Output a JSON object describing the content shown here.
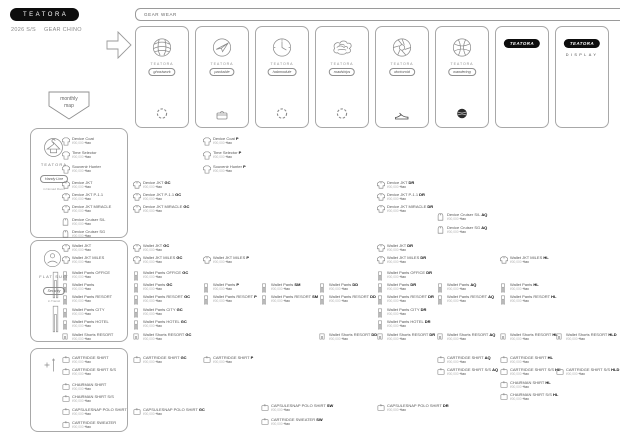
{
  "colors": {
    "accent": "#0d0d0d",
    "border": "#a8a8a8",
    "text": "#555555",
    "muted": "#b3b3b3"
  },
  "header": {
    "logo": "TEATORA",
    "season": "2026 S/S",
    "theme": "GEAR CHINO"
  },
  "banner": {
    "label": "GEAR WEAR"
  },
  "badge": {
    "line1": "monthly",
    "line2": "map"
  },
  "defaults": {
    "price": "¥00,000",
    "tax": "+tax"
  },
  "cards": [
    {
      "type": "icon",
      "brand": "TEATORA",
      "tag": "ghostwork",
      "icon": "globe-scribble-icon",
      "bottom_icon": "gear-ring-icon"
    },
    {
      "type": "icon",
      "brand": "TEATORA",
      "tag": "packable",
      "icon": "plane-scribble-icon",
      "bottom_icon": "basket-icon"
    },
    {
      "type": "icon",
      "brand": "TEATORA",
      "tag": "habmodule",
      "icon": "dial-scribble-icon",
      "bottom_icon": "gear-ring-icon"
    },
    {
      "type": "icon",
      "brand": "TEATORA",
      "tag": "roadships",
      "icon": "cloud-scribble-icon",
      "bottom_icon": "gear-ring-icon"
    },
    {
      "type": "icon",
      "brand": "TEATORA",
      "tag": "doctoroid",
      "icon": "aperture-scribble-icon",
      "bottom_icon": "sneaker-icon"
    },
    {
      "type": "icon",
      "brand": "TEATORA",
      "tag": "wandering",
      "icon": "yarn-scribble-icon",
      "bottom_icon": "knit-ball-icon"
    },
    {
      "type": "logo",
      "logo": "TEATORA"
    },
    {
      "type": "logo",
      "logo": "TEATORA",
      "sub": "DISPLAY"
    }
  ],
  "sections": [
    {
      "id": "outer",
      "box": {
        "y": 128,
        "h": 108
      },
      "header": {
        "brand": "TEATORA",
        "tag": "Handy Line",
        "caption": "in Nomad Room",
        "icon": "hanger-doodle-icon"
      },
      "items": [
        {
          "name": "Device Coat",
          "icon": "coat",
          "y": 137
        },
        {
          "name": "Time Selector",
          "icon": "coat",
          "y": 151
        },
        {
          "name": "Souvenir Hunter",
          "icon": "coat",
          "y": 165
        },
        {
          "name": "Device JKT",
          "icon": "jacket",
          "y": 181
        },
        {
          "name": "Device JKT P-1.1",
          "icon": "jacket",
          "y": 193
        },
        {
          "name": "Device JKT MIRACLE",
          "icon": "jacket",
          "y": 205
        },
        {
          "name": "Device Cruiser S/L",
          "icon": "vest",
          "y": 218
        },
        {
          "name": "Device Cruiser SG",
          "icon": "vest",
          "y": 230
        }
      ]
    },
    {
      "id": "pants",
      "box": {
        "y": 240,
        "h": 100
      },
      "header": {
        "brand": "FLAT SUIT",
        "tag": "Security",
        "caption": "in Transit",
        "icon": "person-doodle-icon"
      },
      "items": [
        {
          "name": "Wallet JKT",
          "icon": "jacket",
          "y": 244
        },
        {
          "name": "Wallet JKT MILES",
          "icon": "jacket",
          "y": 256
        },
        {
          "name": "Wallet Pants OFFICE",
          "icon": "pants",
          "y": 271
        },
        {
          "name": "Wallet Pants",
          "icon": "pants",
          "y": 283
        },
        {
          "name": "Wallet Pants RESORT",
          "icon": "pants",
          "y": 295
        },
        {
          "name": "Wallet Pants CITY",
          "icon": "pants",
          "y": 308
        },
        {
          "name": "Wallet Pants HOTEL",
          "icon": "pants",
          "y": 320
        },
        {
          "name": "Wallet Shorts RESORT",
          "icon": "shorts",
          "y": 333
        }
      ]
    },
    {
      "id": "shirts",
      "box": {
        "y": 348,
        "h": 82
      },
      "header": {
        "icon": "hanger-plus-icon"
      },
      "items": [
        {
          "name": "CARTRIDGE SHIRT",
          "icon": "shirt",
          "y": 356
        },
        {
          "name": "CARTRIDGE SHIRT S/S",
          "icon": "shirt",
          "y": 368
        },
        {
          "name": "CHAIRMAN SHIRT",
          "icon": "shirt",
          "y": 383
        },
        {
          "name": "CHAIRMAN SHIRT S/S",
          "icon": "shirt",
          "y": 395
        },
        {
          "name": "CAPSULESNAP POLO SHIRT",
          "icon": "shirt",
          "y": 408
        },
        {
          "name": "CARTRIDGE SWEATER",
          "icon": "shirt",
          "y": 421
        }
      ]
    }
  ],
  "grid": {
    "columns_x": [
      133,
      203,
      261,
      319,
      377,
      437,
      500,
      556
    ],
    "items": [
      {
        "c": 1,
        "y": 137,
        "name": "Device Coat",
        "code": "P",
        "icon": "coat"
      },
      {
        "c": 1,
        "y": 151,
        "name": "Time Selector",
        "code": "P",
        "icon": "coat"
      },
      {
        "c": 1,
        "y": 165,
        "name": "Souvenir Hunter",
        "code": "P",
        "icon": "coat"
      },
      {
        "c": 0,
        "y": 181,
        "name": "Device JKT",
        "code": "GC",
        "icon": "jacket"
      },
      {
        "c": 0,
        "y": 193,
        "name": "Device JKT P-1.1",
        "code": "GC",
        "icon": "jacket"
      },
      {
        "c": 0,
        "y": 205,
        "name": "Device JKT MIRACLE",
        "code": "GC",
        "icon": "jacket"
      },
      {
        "c": 4,
        "y": 181,
        "name": "Device JKT",
        "code": "DR",
        "icon": "jacket"
      },
      {
        "c": 4,
        "y": 193,
        "name": "Device JKT P-1.1",
        "code": "DR",
        "icon": "jacket"
      },
      {
        "c": 4,
        "y": 205,
        "name": "Device JKT MIRACLE",
        "code": "DR",
        "icon": "jacket"
      },
      {
        "c": 5,
        "y": 213,
        "name": "Device Cruiser S/L",
        "code": "AQ",
        "icon": "vest"
      },
      {
        "c": 5,
        "y": 226,
        "name": "Device Cruiser SG",
        "code": "AQ",
        "icon": "vest"
      },
      {
        "c": 0,
        "y": 244,
        "name": "Wallet JKT",
        "code": "GC",
        "icon": "jacket"
      },
      {
        "c": 0,
        "y": 256,
        "name": "Wallet JKT MILES",
        "code": "GC",
        "icon": "jacket"
      },
      {
        "c": 0,
        "y": 271,
        "name": "Wallet Pants OFFICE",
        "code": "GC",
        "icon": "pants"
      },
      {
        "c": 0,
        "y": 283,
        "name": "Wallet Pants",
        "code": "GC",
        "icon": "pants"
      },
      {
        "c": 0,
        "y": 295,
        "name": "Wallet Pants RESORT",
        "code": "GC",
        "icon": "pants"
      },
      {
        "c": 0,
        "y": 308,
        "name": "Wallet Pants CITY",
        "code": "GC",
        "icon": "pants"
      },
      {
        "c": 0,
        "y": 320,
        "name": "Wallet Pants HOTEL",
        "code": "GC",
        "icon": "pants"
      },
      {
        "c": 0,
        "y": 333,
        "name": "Wallet Shorts RESORT",
        "code": "GC",
        "icon": "shorts"
      },
      {
        "c": 1,
        "y": 256,
        "name": "Wallet JKT MILES",
        "code": "P",
        "icon": "jacket"
      },
      {
        "c": 1,
        "y": 283,
        "name": "Wallet Pants",
        "code": "P",
        "icon": "pants"
      },
      {
        "c": 1,
        "y": 295,
        "name": "Wallet Pants RESORT",
        "code": "P",
        "icon": "pants"
      },
      {
        "c": 2,
        "y": 283,
        "name": "Wallet Pants",
        "code": "SM",
        "icon": "pants"
      },
      {
        "c": 2,
        "y": 295,
        "name": "Wallet Pants RESORT",
        "code": "SM",
        "icon": "pants"
      },
      {
        "c": 3,
        "y": 283,
        "name": "Wallet Pants",
        "code": "DD",
        "icon": "pants"
      },
      {
        "c": 3,
        "y": 295,
        "name": "Wallet Pants RESORT",
        "code": "DD",
        "icon": "pants"
      },
      {
        "c": 3,
        "y": 333,
        "name": "Wallet Shorts RESORT",
        "code": "DD",
        "icon": "shorts"
      },
      {
        "c": 4,
        "y": 244,
        "name": "Wallet JKT",
        "code": "DR",
        "icon": "jacket"
      },
      {
        "c": 4,
        "y": 256,
        "name": "Wallet JKT MILES",
        "code": "DR",
        "icon": "jacket"
      },
      {
        "c": 4,
        "y": 271,
        "name": "Wallet Pants OFFICE",
        "code": "DR",
        "icon": "pants"
      },
      {
        "c": 4,
        "y": 283,
        "name": "Wallet Pants",
        "code": "DR",
        "icon": "pants"
      },
      {
        "c": 4,
        "y": 295,
        "name": "Wallet Pants RESORT",
        "code": "DR",
        "icon": "pants"
      },
      {
        "c": 4,
        "y": 308,
        "name": "Wallet Pants CITY",
        "code": "DR",
        "icon": "pants"
      },
      {
        "c": 4,
        "y": 320,
        "name": "Wallet Pants HOTEL",
        "code": "DR",
        "icon": "pants"
      },
      {
        "c": 4,
        "y": 333,
        "name": "Wallet Shorts RESORT",
        "code": "DR",
        "icon": "shorts"
      },
      {
        "c": 5,
        "y": 283,
        "name": "Wallet Pants",
        "code": "AQ",
        "icon": "pants"
      },
      {
        "c": 5,
        "y": 295,
        "name": "Wallet Pants RESORT",
        "code": "AQ",
        "icon": "pants"
      },
      {
        "c": 5,
        "y": 333,
        "name": "Wallet Shorts RESORT",
        "code": "AQ",
        "icon": "shorts"
      },
      {
        "c": 6,
        "y": 256,
        "name": "Wallet JKT MILES",
        "code": "HL",
        "icon": "jacket"
      },
      {
        "c": 6,
        "y": 283,
        "name": "Wallet Pants",
        "code": "HL",
        "icon": "pants"
      },
      {
        "c": 6,
        "y": 295,
        "name": "Wallet Pants RESORT",
        "code": "HL",
        "icon": "pants"
      },
      {
        "c": 6,
        "y": 333,
        "name": "Wallet Shorts RESORT",
        "code": "HL",
        "icon": "shorts"
      },
      {
        "c": 7,
        "y": 333,
        "name": "Wallet Shorts RESORT",
        "code": "HLD",
        "icon": "shorts"
      },
      {
        "c": 0,
        "y": 356,
        "name": "CARTRIDGE SHIRT",
        "code": "GC",
        "icon": "shirt"
      },
      {
        "c": 0,
        "y": 408,
        "name": "CAPSULESNAP POLO SHIRT",
        "code": "GC",
        "icon": "shirt"
      },
      {
        "c": 1,
        "y": 356,
        "name": "CARTRIDGE SHIRT",
        "code": "P",
        "icon": "shirt"
      },
      {
        "c": 2,
        "y": 404,
        "name": "CAPSULESNAP POLO SHIRT",
        "code": "SW",
        "icon": "shirt"
      },
      {
        "c": 2,
        "y": 418,
        "name": "CARTRIDGE SWEATER",
        "code": "SW",
        "icon": "shirt"
      },
      {
        "c": 4,
        "y": 404,
        "name": "CAPSULESNAP POLO SHIRT",
        "code": "DR",
        "icon": "shirt"
      },
      {
        "c": 5,
        "y": 356,
        "name": "CARTRIDGE SHIRT",
        "code": "AQ",
        "icon": "shirt"
      },
      {
        "c": 5,
        "y": 368,
        "name": "CARTRIDGE SHIRT S/S",
        "code": "AQ",
        "icon": "shirt"
      },
      {
        "c": 6,
        "y": 356,
        "name": "CARTRIDGE SHIRT",
        "code": "HL",
        "icon": "shirt"
      },
      {
        "c": 6,
        "y": 368,
        "name": "CARTRIDGE SHIRT S/S",
        "code": "HL",
        "icon": "shirt"
      },
      {
        "c": 6,
        "y": 381,
        "name": "CHAIRMAN SHIRT",
        "code": "HL",
        "icon": "shirt"
      },
      {
        "c": 6,
        "y": 393,
        "name": "CHAIRMAN SHIRT S/S",
        "code": "HL",
        "icon": "shirt"
      },
      {
        "c": 7,
        "y": 368,
        "name": "CARTRIDGE SHIRT S/S",
        "code": "HLD",
        "icon": "shirt"
      }
    ]
  }
}
